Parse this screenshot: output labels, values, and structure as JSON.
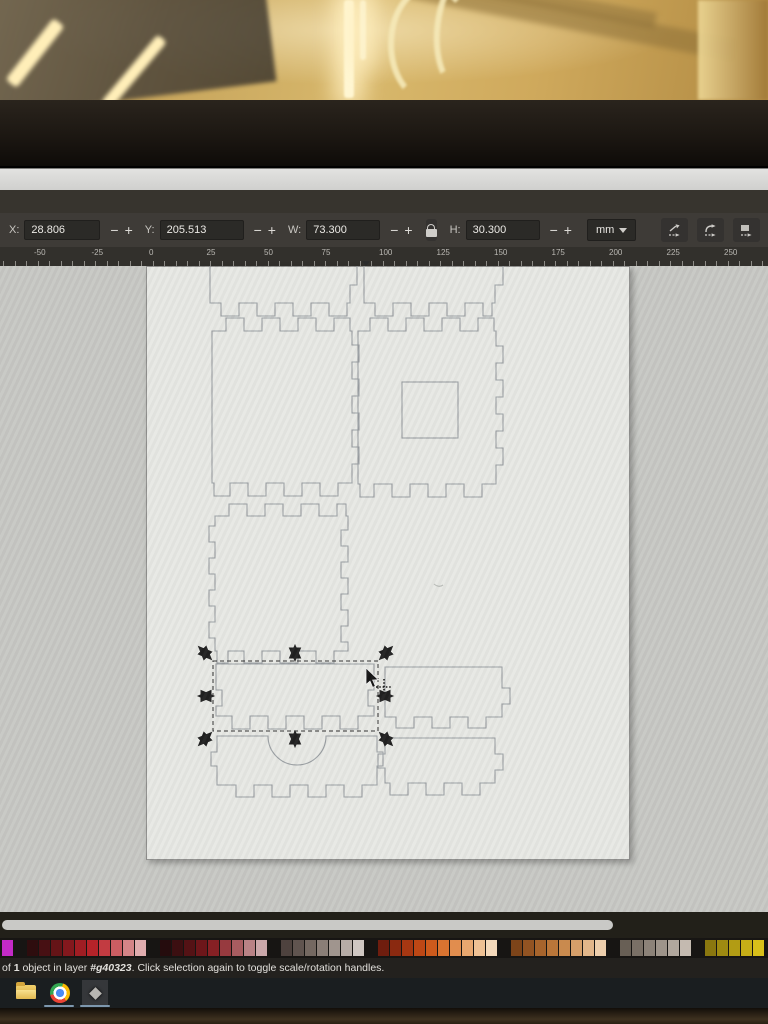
{
  "toolbar": {
    "fields": [
      {
        "label": "X:",
        "value": "28.806"
      },
      {
        "label": "Y:",
        "value": "205.513"
      },
      {
        "label": "W:",
        "value": "73.300"
      },
      {
        "label": "H:",
        "value": "30.300"
      }
    ],
    "spinner_minus": "−",
    "spinner_plus": "+",
    "unit": "mm",
    "buttons": [
      {
        "name": "scale-stroke-width-toggle"
      },
      {
        "name": "scale-rounded-corners-toggle"
      },
      {
        "name": "move-gradients-toggle"
      },
      {
        "name": "move-patterns-toggle"
      }
    ]
  },
  "ruler": {
    "unit": "mm",
    "labels": [
      "-50",
      "-25",
      "0",
      "25",
      "50",
      "75",
      "100",
      "125",
      "150",
      "175",
      "200",
      "225",
      "250"
    ],
    "origin_px": 146,
    "px_per_mm": 2.3,
    "minor_step_mm": 5,
    "range_mm": [
      -62,
      268
    ]
  },
  "statusbar": {
    "before_count": "of ",
    "count": "1",
    "after_count": " object in layer ",
    "layer": "#g40323",
    "after_layer": ". Click selection again to toggle scale/rotation handles."
  },
  "palette": {
    "groups": [
      [
        "#c32ac6"
      ],
      [
        "#2e0d0e",
        "#471013",
        "#651417",
        "#83181d",
        "#a01d23",
        "#b62329",
        "#c23b41",
        "#cb5d62",
        "#d48487",
        "#dfacae"
      ],
      [
        "#250c0d",
        "#3c0f11",
        "#541215",
        "#6d161a",
        "#862024",
        "#973a3f",
        "#a85c60",
        "#b98285",
        "#cba8aa"
      ],
      [
        "#4e423e",
        "#60544f",
        "#746861",
        "#8a7e77",
        "#a0958e",
        "#b7ada7",
        "#cfc7c2"
      ],
      [
        "#6f1d0e",
        "#8a2910",
        "#a63712",
        "#bd4715",
        "#cd5a1c",
        "#d97330",
        "#e18d4e",
        "#e8a76f",
        "#efc194",
        "#f4d9bb"
      ],
      [
        "#7d4419",
        "#925322",
        "#a7642c",
        "#ba7639",
        "#c98a4e",
        "#d69f6a",
        "#e2b68a",
        "#edceac"
      ],
      [
        "#685f55",
        "#7a7066",
        "#8c8278",
        "#9e948a",
        "#b1a79d",
        "#c4bab0"
      ],
      [
        "#8a770f",
        "#9e8a11",
        "#b29c14",
        "#c6ae17",
        "#d8bf1a"
      ]
    ]
  },
  "taskbar": {
    "icons": [
      "folder-icon",
      "chrome-icon",
      "diamond-app-icon"
    ]
  },
  "colors": {
    "toolbar_bg": "#3e3b37",
    "ruler_bg": "#32302c",
    "canvas_bg": "#c6c7c3",
    "page_bg": "#e7e8e4",
    "outline_stroke": "#989da1",
    "selection_dash": "#2b2b2b",
    "statusbar_bg": "#23211e",
    "taskbar_bg": "#1a1e20"
  }
}
